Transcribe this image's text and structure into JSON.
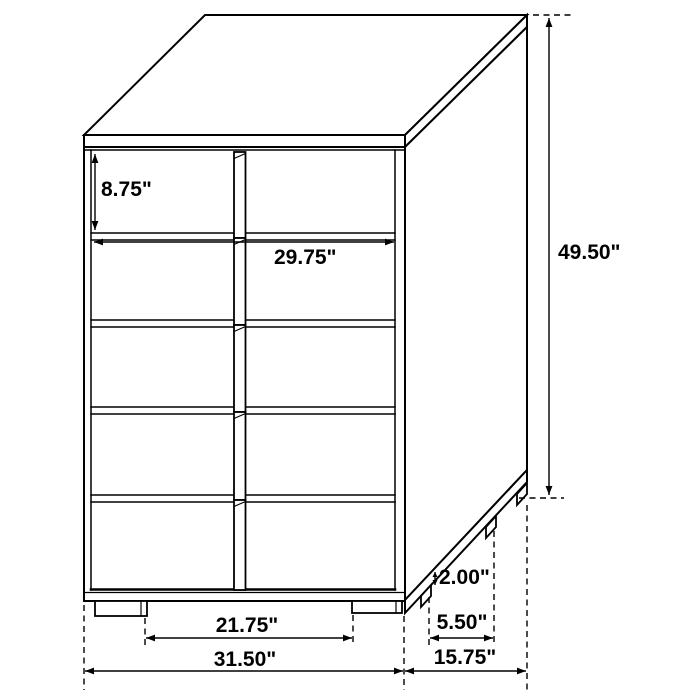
{
  "labels": {
    "drawer_height": "8.75\"",
    "opening_width": "29.75\"",
    "overall_height": "49.50\"",
    "foot_height": "2.00\"",
    "side_feet_spacing": "5.50\"",
    "front_feet_spacing": "21.75\"",
    "overall_width": "31.50\"",
    "overall_depth": "15.75\""
  },
  "colors": {
    "background": "#ffffff",
    "line": "#000000",
    "text": "#000000"
  }
}
